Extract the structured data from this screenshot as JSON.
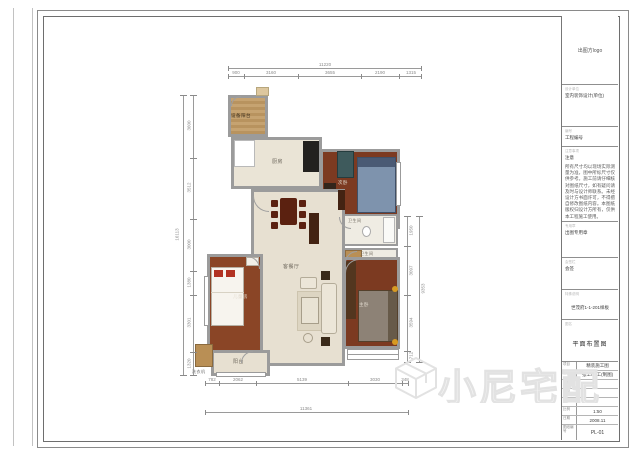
{
  "title_block": {
    "logo_text": "出图方logo",
    "unit": {
      "header": "设计单位",
      "value": "室内装饰设计(单位)"
    },
    "project": {
      "header": "编号",
      "value": "工程编号"
    },
    "notes": {
      "header": "注意事项",
      "label": "注意",
      "text": "所有尺寸均以现场实际测量为准，图中所标尺寸仅供参考。施工前请仔细核对图纸尺寸，如有疑问请及时与设计师联系。未经设计方书面许可，不得擅自修改图纸内容。本图纸版权归设计方所有，仅供本工程施工使用。"
    },
    "stamp": {
      "header": "专用章",
      "label": "出图专用章"
    },
    "countersign": {
      "header": "会签栏",
      "label": "会签"
    },
    "special": {
      "header": "特殊说明",
      "value": "世茂府1-1-201样板"
    },
    "drawing_name": {
      "header": "图名",
      "value": "平面布置图"
    },
    "table": {
      "rows": [
        {
          "label": "项目",
          "value": "精装施工图"
        },
        {
          "label": "设计",
          "value": "张工/李工(制图)"
        },
        {
          "label": "制图",
          "value": ""
        },
        {
          "label": "校对",
          "value": ""
        },
        {
          "label": "审核",
          "value": ""
        },
        {
          "label": "比例",
          "value": "1:50"
        },
        {
          "label": "日期",
          "value": "2008.11"
        },
        {
          "label": "图纸编号",
          "value": "PL-01"
        }
      ]
    }
  },
  "plan": {
    "rooms": {
      "equip_balcony": "设备阳台",
      "kitchen": "厨房",
      "bedroom2": "次卧",
      "bath1": "卫生间",
      "bath2": "卫生间",
      "living": "客餐厅",
      "master": "主卧",
      "kids": "儿童房",
      "balcony": "阳台",
      "washer": "洗衣机"
    },
    "dims": {
      "top": {
        "overall": "11220",
        "segments": [
          "900",
          "3160",
          "3655",
          "2190",
          "1315"
        ]
      },
      "bottom": {
        "overall": "11361",
        "segments": [
          "782",
          "2062",
          "5139",
          "3030",
          "348"
        ]
      },
      "left": {
        "overall": "16113",
        "segments": [
          "3600",
          "3512",
          "3000",
          "1380",
          "3301",
          "1320"
        ]
      },
      "right": {
        "overall": "9353",
        "segments": [
          "1950",
          "3097",
          "3594",
          "712"
        ]
      }
    }
  },
  "watermark": {
    "text": "小尼宅配",
    "logo": "cube-logo"
  },
  "colors": {
    "wall": "#9b9b9b",
    "floor_light": "#e7e0d1",
    "floor_dark": "#7c3a21",
    "floor_kids": "#8a4526",
    "wood": "#b98f55",
    "bed_blue": "#7e93ad",
    "accent_gold": "#d79a23"
  }
}
